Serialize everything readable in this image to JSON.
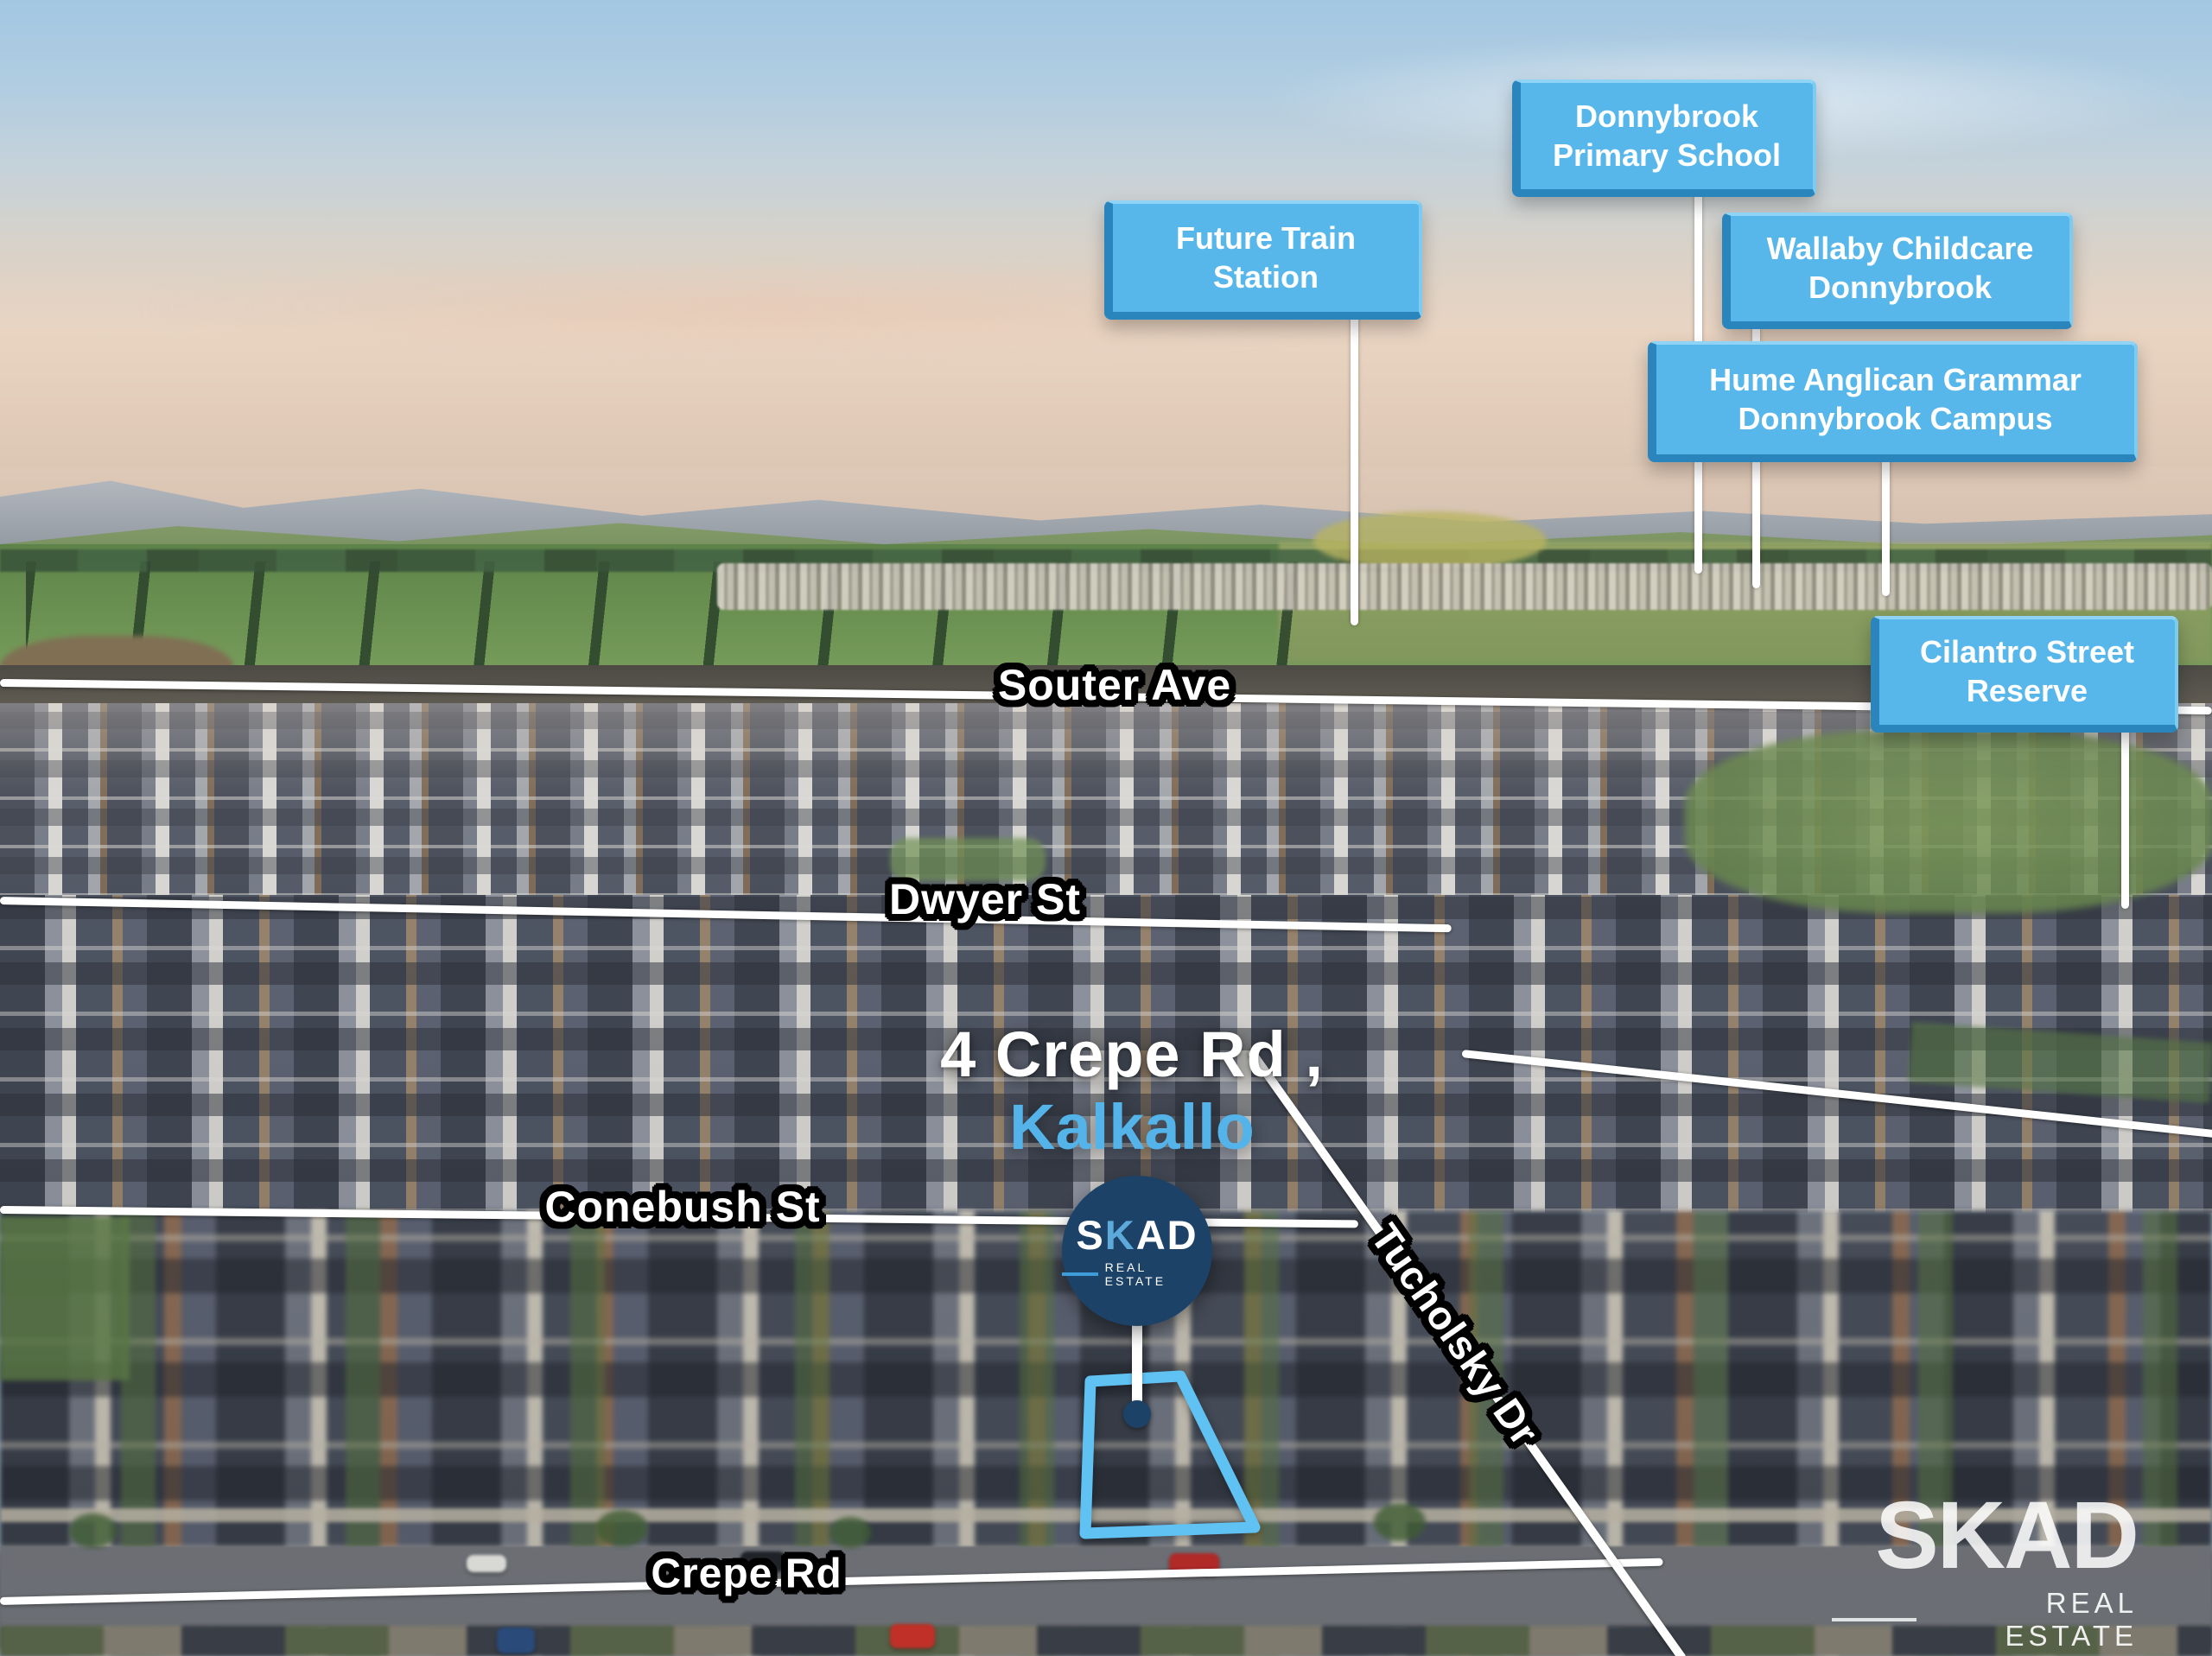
{
  "page": {
    "type": "aerial-property-marketing-image",
    "suburb": "Kalkallo"
  },
  "heading": {
    "line1": "4 Crepe Rd ,",
    "line2": "Kalkallo",
    "line2_color": "#54b3e9"
  },
  "callouts": [
    {
      "id": "future-train-station",
      "label": "Future Train\nStation"
    },
    {
      "id": "donnybrook-primary-school",
      "label": "Donnybrook\nPrimary School"
    },
    {
      "id": "wallaby-childcare-donnybrook",
      "label": "Wallaby Childcare\nDonnybrook"
    },
    {
      "id": "hume-anglican-grammar",
      "label": "Hume Anglican Grammar\nDonnybrook Campus"
    },
    {
      "id": "cilantro-street-reserve",
      "label": "Cilantro Street\nReserve"
    }
  ],
  "streets": [
    {
      "id": "souter-ave",
      "label": "Souter Ave"
    },
    {
      "id": "dwyer-st",
      "label": "Dwyer St"
    },
    {
      "id": "conebush-st",
      "label": "Conebush St"
    },
    {
      "id": "crepe-rd",
      "label": "Crepe Rd"
    },
    {
      "id": "tucholsky-dr",
      "label": "Tucholsky Dr"
    }
  ],
  "badge": {
    "brand_start": "S",
    "brand_accent": "K",
    "brand_end": "AD",
    "sub": "REAL ESTATE"
  },
  "watermark": {
    "brand": "SKAD",
    "sub": "REAL ESTATE"
  },
  "colors": {
    "callout_fill": "#58b7ea",
    "callout_edge": "#2a85bd",
    "accent_blue": "#54b3e9",
    "badge_navy": "#1d4268",
    "property_outline": "#60c1f3",
    "street_text": "#ffffff",
    "street_outline": "#000000",
    "leader_line": "#ffffff"
  }
}
